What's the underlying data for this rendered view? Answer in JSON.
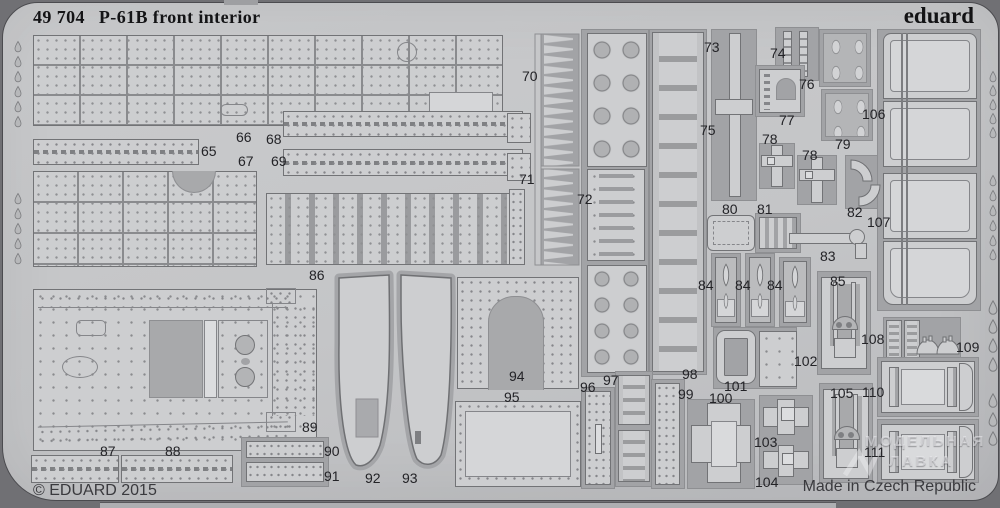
{
  "header": {
    "catalog_number": "49 704",
    "product_name": "P-61B front interior",
    "brand": "eduard"
  },
  "footer": {
    "copyright": "© EDUARD 2015",
    "made_in": "Made in Czech Republic"
  },
  "watermark": {
    "line1": "МОДЕЛЬНАЯ",
    "line2": "ЛАВКА"
  },
  "colors": {
    "fret_metal": "#c6c7c9",
    "etched_recess": "#a2a3a6",
    "part_surface": "#cdced0",
    "outline": "#727376",
    "background": "#707074",
    "text": "#1a1a1c"
  },
  "parts": [
    {
      "num": "65",
      "x": 198,
      "y": 141
    },
    {
      "num": "66",
      "x": 233,
      "y": 127
    },
    {
      "num": "67",
      "x": 235,
      "y": 151
    },
    {
      "num": "68",
      "x": 263,
      "y": 129
    },
    {
      "num": "69",
      "x": 268,
      "y": 151
    },
    {
      "num": "70",
      "x": 519,
      "y": 66
    },
    {
      "num": "71",
      "x": 516,
      "y": 169
    },
    {
      "num": "72",
      "x": 574,
      "y": 189
    },
    {
      "num": "73",
      "x": 701,
      "y": 37
    },
    {
      "num": "74",
      "x": 767,
      "y": 43
    },
    {
      "num": "75",
      "x": 697,
      "y": 120
    },
    {
      "num": "76",
      "x": 796,
      "y": 74
    },
    {
      "num": "77",
      "x": 776,
      "y": 110
    },
    {
      "num": "78",
      "x": 759,
      "y": 129
    },
    {
      "num": "78",
      "x": 799,
      "y": 145
    },
    {
      "num": "79",
      "x": 832,
      "y": 134
    },
    {
      "num": "80",
      "x": 719,
      "y": 199
    },
    {
      "num": "81",
      "x": 754,
      "y": 199
    },
    {
      "num": "82",
      "x": 844,
      "y": 202
    },
    {
      "num": "83",
      "x": 817,
      "y": 246
    },
    {
      "num": "84",
      "x": 695,
      "y": 275
    },
    {
      "num": "84",
      "x": 732,
      "y": 275
    },
    {
      "num": "84",
      "x": 764,
      "y": 275
    },
    {
      "num": "85",
      "x": 827,
      "y": 271
    },
    {
      "num": "86",
      "x": 306,
      "y": 265
    },
    {
      "num": "87",
      "x": 97,
      "y": 441
    },
    {
      "num": "88",
      "x": 162,
      "y": 441
    },
    {
      "num": "89",
      "x": 299,
      "y": 417
    },
    {
      "num": "90",
      "x": 321,
      "y": 441
    },
    {
      "num": "91",
      "x": 321,
      "y": 466
    },
    {
      "num": "92",
      "x": 362,
      "y": 468
    },
    {
      "num": "93",
      "x": 399,
      "y": 468
    },
    {
      "num": "94",
      "x": 506,
      "y": 366
    },
    {
      "num": "95",
      "x": 501,
      "y": 387
    },
    {
      "num": "96",
      "x": 577,
      "y": 377
    },
    {
      "num": "97",
      "x": 600,
      "y": 370
    },
    {
      "num": "98",
      "x": 679,
      "y": 364
    },
    {
      "num": "99",
      "x": 675,
      "y": 384
    },
    {
      "num": "100",
      "x": 706,
      "y": 388
    },
    {
      "num": "101",
      "x": 721,
      "y": 376
    },
    {
      "num": "102",
      "x": 791,
      "y": 351
    },
    {
      "num": "103",
      "x": 751,
      "y": 432
    },
    {
      "num": "104",
      "x": 752,
      "y": 472
    },
    {
      "num": "105",
      "x": 827,
      "y": 383
    },
    {
      "num": "106",
      "x": 859,
      "y": 104
    },
    {
      "num": "107",
      "x": 864,
      "y": 212
    },
    {
      "num": "108",
      "x": 858,
      "y": 329
    },
    {
      "num": "109",
      "x": 953,
      "y": 337
    },
    {
      "num": "110",
      "x": 859,
      "y": 382
    },
    {
      "num": "111",
      "x": 861,
      "y": 442
    }
  ]
}
